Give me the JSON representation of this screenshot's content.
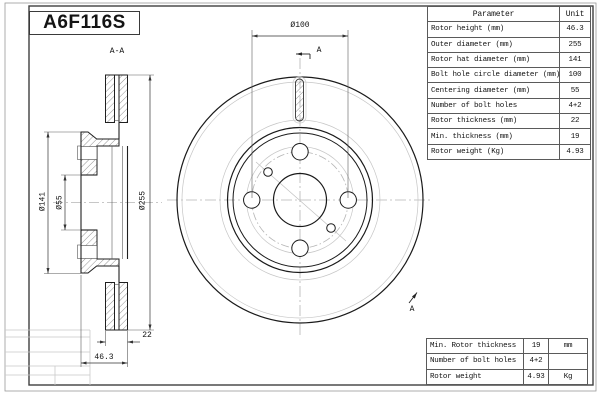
{
  "title": "A6F116S",
  "section_view": {
    "label": "A-A",
    "dims": {
      "hat_diameter": "Ø141",
      "centering_diameter": "Ø55",
      "outer_diameter": "Ø255",
      "rotor_thickness": "22",
      "rotor_height": "46.3"
    }
  },
  "front_view": {
    "dims": {
      "bolt_circle_diameter": "Ø100"
    },
    "section_marker_top": "A",
    "section_marker_bottom": "A"
  },
  "parameter_table": {
    "headers": [
      "Parameter",
      "Unit"
    ],
    "rows": [
      {
        "param": "Rotor height (mm)",
        "value": "46.3"
      },
      {
        "param": "Outer diameter (mm)",
        "value": "255"
      },
      {
        "param": "Rotor hat diameter (mm)",
        "value": "141"
      },
      {
        "param": "Bolt hole circle diameter (mm)",
        "value": "100"
      },
      {
        "param": "Centering diameter (mm)",
        "value": "55"
      },
      {
        "param": "Number of bolt holes",
        "value": "4+2"
      },
      {
        "param": "Rotor thickness (mm)",
        "value": "22"
      },
      {
        "param": "Min. thickness (mm)",
        "value": "19"
      },
      {
        "param": "Rotor weight (Kg)",
        "value": "4.93"
      }
    ]
  },
  "summary_table": {
    "rows": [
      {
        "param": "Min. Rotor thickness",
        "value": "19",
        "unit": "mm"
      },
      {
        "param": "Number of bolt holes",
        "value": "4+2",
        "unit": ""
      },
      {
        "param": "Rotor weight",
        "value": "4.93",
        "unit": "Kg"
      }
    ]
  },
  "colors": {
    "main_line": "#1a1a1a",
    "centerline": "#b5b5b5",
    "faint_line": "#c6c6c6"
  }
}
